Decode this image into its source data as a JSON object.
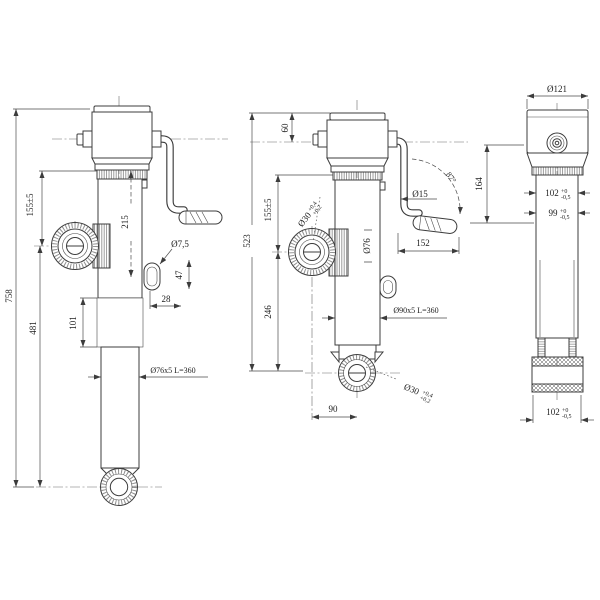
{
  "background": "#ffffff",
  "colors": {
    "line": "#3c3c3c",
    "dim": "#4a4a4a",
    "text": "#1e1e1e"
  },
  "views": {
    "left": {
      "dim_total": "758",
      "dim_lower": "481",
      "dim_eye_offset": "155±5",
      "dim_stroke": "215",
      "dim_overlap": "101",
      "dim_28": "28",
      "dim_hole": "Ø7,5",
      "dim_slot": "47",
      "dim_tube": "Ø76x5 L=360"
    },
    "middle": {
      "dim_total": "523",
      "dim_top": "60",
      "dim_eye_offset": "155±5",
      "dim_lower": "246",
      "dim_tube_inner": "Ø76",
      "dim_tube": "Ø90x5 L=360",
      "dim_crank_dia": "Ø15",
      "dim_crank_angle": "87°",
      "dim_crank_len": "152",
      "dim_eye_base": "90",
      "eye_bore": "Ø30",
      "eye_tol_hi": "+0,4",
      "eye_tol_lo": "+0,2"
    },
    "right": {
      "dim_head_dia": "Ø121",
      "dim_head_len": "164",
      "dim_flat_a": "102",
      "dim_flat_b": "99",
      "dim_flat_c": "102",
      "tol_hi": "+0",
      "tol_lo": "-0,5"
    }
  }
}
